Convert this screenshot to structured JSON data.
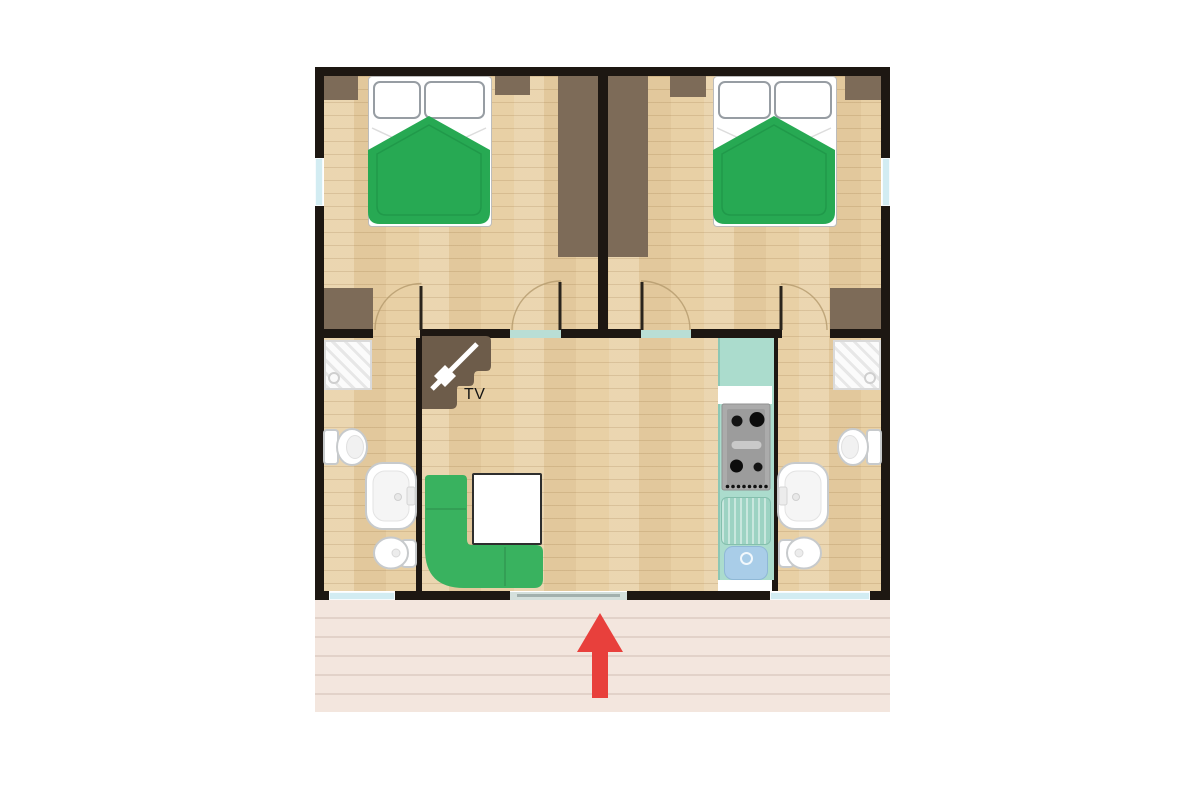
{
  "labels": {
    "tv": "TV"
  },
  "icons": {
    "beds": "double-bed-icon",
    "sofa": "corner-sofa-icon",
    "tv": "tv-icon",
    "stove": "stove-icon",
    "kitchen_sink": "kitchen-sink-icon",
    "shower": "shower-icon",
    "toilet": "toilet-icon",
    "washbasin": "washbasin-icon",
    "bidet": "bidet-icon",
    "entrance": "entrance-arrow-icon"
  },
  "colors": {
    "wall": "#1d1712",
    "floor": "#e8d0a5",
    "wardrobe": "#7d6b58",
    "tv_unit": "#6d5c4a",
    "bed_green": "#27a953",
    "bed_green_dark": "#1d8f44",
    "sofa_green": "#39b25f",
    "kitchen_teal": "#abdccd",
    "kitchen_edge": "#8cc7b5",
    "drainboard": "#9dd3c3",
    "stove_gray": "#ababab",
    "sink_blue": "#a9cde8",
    "window_blue": "#d2ecf2",
    "threshold": "#b9ded5",
    "entrance": "#d4e0dc",
    "entrance_line": "#a2b0ad",
    "deck": "#f3e6de",
    "deck_line": "#e2d2c9",
    "arrow_red": "#e8403c",
    "fixture_stroke": "#c7cacc",
    "leaf": "#2a241c",
    "arc": "#b49a6d"
  }
}
